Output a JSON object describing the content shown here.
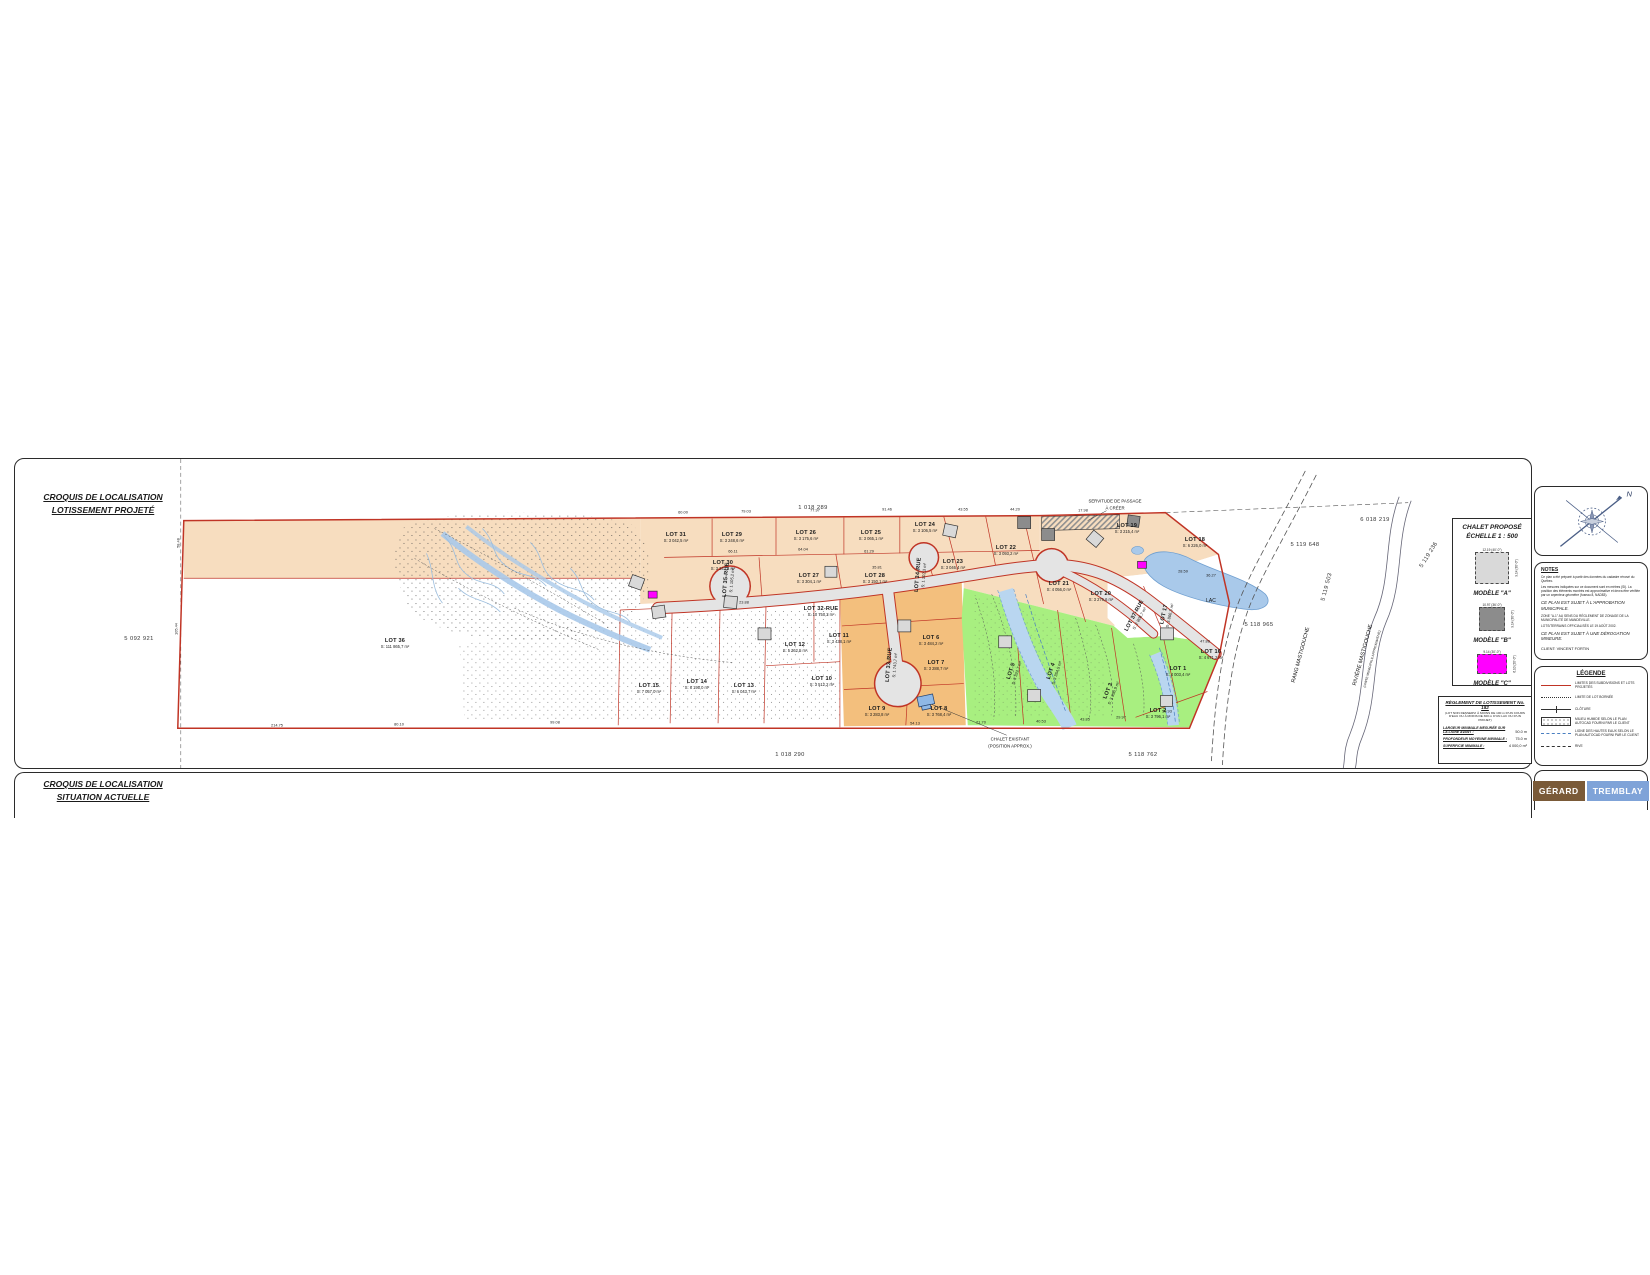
{
  "sheet1": {
    "title_line1": "CROQUIS DE LOCALISATION",
    "title_line2": "LOTISSEMENT PROJETÉ"
  },
  "sheet2": {
    "title_line1": "CROQUIS DE LOCALISATION",
    "title_line2": "SITUATION ACTUELLE"
  },
  "compass": {
    "north_label": "N"
  },
  "chalet_block": {
    "title_line1": "CHALET PROPOSÉ",
    "title_line2": "ÉCHELLE 1 : 500",
    "models": [
      {
        "label": "MODÈLE \"A\"",
        "color": "#d9d9d9",
        "top_dim": "12.19 (40'-0\")",
        "side_dim": "9.14 (30'-0\")",
        "w": 34,
        "h": 32
      },
      {
        "label": "MODÈLE \"B\"",
        "color": "#8c8c8c",
        "top_dim": "10.97 (36'-0\")",
        "side_dim": "9.14 (30'-0\")",
        "w": 26,
        "h": 24
      },
      {
        "label": "MODÈLE \"C\"",
        "color": "#ff00ff",
        "top_dim": "9.14 (30'-0\")",
        "side_dim": "6.10 (20'-0\")",
        "w": 30,
        "h": 20
      }
    ]
  },
  "reglement": {
    "title": "RÈGLEMENT DE LOTISSEMENT No. 182",
    "subtitle": "(LOT NON DESSERVI À MOINS DE 100 m D'UN COURS D'EAU OU À MOINS DE 300 m D'UN LAC OU D'UN PROJET)",
    "rows": [
      {
        "label": "LARGEUR MINIMALE MESURÉE SUR LA LIGNE AVANT :",
        "value": "50.0 m"
      },
      {
        "label": "PROFONDEUR MOYENNE MINIMALE :",
        "value": "75.0 m"
      },
      {
        "label": "SUPERFICIE MINIMALE :",
        "value": "4 000,0 m²"
      }
    ]
  },
  "notes": {
    "title": "NOTES",
    "lines": [
      "Ce plan a été préparé à partir des données du cadastre rénové du Québec.",
      "Les mesures indiquées sur ce document sont en mètres (SI). La position des éléments montrés est approximative et devra être vérifiée par un arpenteur-géomètre (fuseau 8, NAD83)."
    ],
    "emph1": "CE PLAN EST SUJET À L'APPROBATION MUNICIPALE.",
    "zone_line": "ZONE \"A-1\" AU SENS DU RÈGLEMENT DE ZONAGE DE LA MUNICIPALITÉ DE MANDEVILLE.",
    "off_line": "LOTS/TERRAINS OFFICIALISÉS LE 19 AOÛT 2002.",
    "emph2": "CE PLAN EST SUJET À UNE DÉROGATION MINEURE.",
    "client": "CLIENT: VINCENT FORTIN"
  },
  "legende": {
    "title": "LÉGENDE",
    "items": [
      {
        "symbol": "red-line",
        "label": "LIMITES DES SUBDIVISIONS ET LOTS PROJETÉS"
      },
      {
        "symbol": "dotted-line",
        "label": "LIMITE DE LOT BORNÉE"
      },
      {
        "symbol": "tick-line",
        "label": "CLÔTURE"
      },
      {
        "symbol": "wetland-box",
        "label": "MILIEU HUMIDE SELON LE PLAN AUTOCAD FOURNI PAR LE CLIENT"
      },
      {
        "symbol": "blue-dash",
        "label": "LIGNE DES HAUTES EAUX SELON LE PLAN AUTOCAD FOURNI PAR LE CLIENT"
      },
      {
        "symbol": "long-dash",
        "label": "RIVE"
      }
    ]
  },
  "logo": {
    "part1": "GÉRARD",
    "part2": "TREMBLAY"
  },
  "plan": {
    "lots": [
      {
        "name": "LOT 36",
        "area": "S: 111 865,7 m²",
        "x": 380,
        "y": 185
      },
      {
        "name": "LOT 15",
        "area": "S: 7 057,0 m²",
        "x": 634,
        "y": 230
      },
      {
        "name": "LOT 14",
        "area": "S: 6 195,0 m²",
        "x": 682,
        "y": 226
      },
      {
        "name": "LOT 13",
        "area": "S: 6 043,7 m²",
        "x": 729,
        "y": 230
      },
      {
        "name": "LOT 12",
        "area": "S: 5 362,5 m²",
        "x": 780,
        "y": 189
      },
      {
        "name": "LOT 11",
        "area": "S: 3 438,1 m²",
        "x": 824,
        "y": 180
      },
      {
        "name": "LOT 10",
        "area": "S: 3 512,2 m²",
        "x": 807,
        "y": 223
      },
      {
        "name": "LOT 9",
        "area": "S: 3 283,8 m²",
        "x": 862,
        "y": 253
      },
      {
        "name": "LOT 8",
        "area": "S: 3 768,4 m²",
        "x": 924,
        "y": 253
      },
      {
        "name": "LOT 7",
        "area": "S: 3 288,7 m²",
        "x": 921,
        "y": 207
      },
      {
        "name": "LOT 6",
        "area": "S: 3 484,2 m²",
        "x": 916,
        "y": 182
      },
      {
        "name": "LOT 5",
        "area": "S: 3 322,7 m²",
        "x": 999,
        "y": 213,
        "rot": -72
      },
      {
        "name": "LOT 4",
        "area": "S: 3 354,5 m²",
        "x": 1039,
        "y": 213,
        "rot": -72
      },
      {
        "name": "LOT 3",
        "area": "S: 3 896,9 m²",
        "x": 1096,
        "y": 233,
        "rot": -68
      },
      {
        "name": "LOT 2",
        "area": "S: 3 796,1 m²",
        "x": 1143,
        "y": 255
      },
      {
        "name": "LOT 1",
        "area": "S: 4 003,4 m²",
        "x": 1163,
        "y": 213
      },
      {
        "name": "LOT 16",
        "area": "S: 4 671,2 m²",
        "x": 1196,
        "y": 196
      },
      {
        "name": "LOT 17",
        "area": "S: 3 866,3 m²",
        "x": 1152,
        "y": 156,
        "rot": -78
      },
      {
        "name": "LOT 18",
        "area": "S: 6 226,0 m²",
        "x": 1180,
        "y": 84
      },
      {
        "name": "LOT 19",
        "area": "S: 3 215,4 m²",
        "x": 1112,
        "y": 70
      },
      {
        "name": "LOT 20",
        "area": "S: 3 276,6 m²",
        "x": 1086,
        "y": 138
      },
      {
        "name": "LOT 21",
        "area": "S: 4 056,0 m²",
        "x": 1044,
        "y": 128
      },
      {
        "name": "LOT 22",
        "area": "S: 3 093,2 m²",
        "x": 991,
        "y": 92
      },
      {
        "name": "LOT 23",
        "area": "S: 3 046,4 m²",
        "x": 938,
        "y": 106
      },
      {
        "name": "LOT 24",
        "area": "S: 3 106,5 m²",
        "x": 910,
        "y": 69
      },
      {
        "name": "LOT 25",
        "area": "S: 3 065,1 m²",
        "x": 856,
        "y": 77
      },
      {
        "name": "LOT 26",
        "area": "S: 3 175,6 m²",
        "x": 791,
        "y": 77
      },
      {
        "name": "LOT 27",
        "area": "S: 3 304,1 m²",
        "x": 794,
        "y": 120
      },
      {
        "name": "LOT 28",
        "area": "S: 3 150,1 m²",
        "x": 860,
        "y": 120
      },
      {
        "name": "LOT 29",
        "area": "S: 3 248,6 m²",
        "x": 717,
        "y": 79
      },
      {
        "name": "LOT 30",
        "area": "S: 3 243,4 m²",
        "x": 708,
        "y": 107
      },
      {
        "name": "LOT 31",
        "area": "S: 3 042,5 m²",
        "x": 661,
        "y": 79
      },
      {
        "name": "LOT 32-RUE",
        "area": "S: 10 750,3 m²",
        "x": 806,
        "y": 153
      },
      {
        "name": "LOT 33-RUE",
        "area": "S: 1 743,7 m²",
        "x": 877,
        "y": 206,
        "rot": -85
      },
      {
        "name": "LOT 34-RUE",
        "area": "S: 1 102,3 m²",
        "x": 906,
        "y": 116,
        "rot": -85
      },
      {
        "name": "LOT 35-RUE",
        "area": "S: 1 105,2 m²",
        "x": 714,
        "y": 121,
        "rot": -85
      },
      {
        "name": "LOT 37-RUE",
        "area": "S: 2 808,7 m²",
        "x": 1122,
        "y": 158,
        "rot": -62
      }
    ],
    "cadastre": [
      {
        "t": "1 018 289",
        "x": 798,
        "y": 49
      },
      {
        "t": "1 018 290",
        "x": 775,
        "y": 296
      },
      {
        "t": "5 092 921",
        "x": 124,
        "y": 180
      },
      {
        "t": "5 119 648",
        "x": 1290,
        "y": 86
      },
      {
        "t": "5 119 503",
        "x": 1312,
        "y": 128,
        "rot": -75
      },
      {
        "t": "5 119 236",
        "x": 1414,
        "y": 96,
        "rot": -58
      },
      {
        "t": "5 118 965",
        "x": 1244,
        "y": 166
      },
      {
        "t": "5 118 762",
        "x": 1128,
        "y": 296
      },
      {
        "t": "6 018 219",
        "x": 1360,
        "y": 61
      }
    ],
    "labels": [
      {
        "t": "SERVITUDE DE PASSAGE",
        "x": 1100,
        "y": 42
      },
      {
        "t": "À CRÉER",
        "x": 1100,
        "y": 49
      },
      {
        "t": "LAC",
        "x": 1196,
        "y": 142,
        "size": 5
      },
      {
        "t": "CHALET EXISTANT",
        "x": 995,
        "y": 280
      },
      {
        "t": "(POSITION APPROX.)",
        "x": 995,
        "y": 287
      },
      {
        "t": "RANG MASTIGOUCHE",
        "x": 1286,
        "y": 196,
        "rot": -75,
        "size": 5.4
      },
      {
        "t": "RIVIÈRE MASTIGOUCHE",
        "x": 1348,
        "y": 196,
        "rot": -75,
        "size": 5.4
      },
      {
        "t": "(LIMITE MUNICIPALE APPROXIMATIVE)",
        "x": 1357,
        "y": 200,
        "rot": -75,
        "size": 3.2
      }
    ],
    "dims": [
      {
        "t": "60.00",
        "x": 668,
        "y": 53
      },
      {
        "t": "79.03",
        "x": 731,
        "y": 52
      },
      {
        "t": "77.97",
        "x": 800,
        "y": 51
      },
      {
        "t": "91.46",
        "x": 872,
        "y": 50
      },
      {
        "t": "43.55",
        "x": 948,
        "y": 50
      },
      {
        "t": "44.20",
        "x": 1000,
        "y": 50
      },
      {
        "t": "17.98",
        "x": 1068,
        "y": 51
      },
      {
        "t": "66.11",
        "x": 718,
        "y": 92
      },
      {
        "t": "64.04",
        "x": 788,
        "y": 90
      },
      {
        "t": "61.29",
        "x": 854,
        "y": 92
      },
      {
        "t": "58.48",
        "x": 163,
        "y": 84,
        "rot": -90
      },
      {
        "t": "105.44",
        "x": 161,
        "y": 170,
        "rot": -90
      },
      {
        "t": "214.75",
        "x": 262,
        "y": 266
      },
      {
        "t": "80.10",
        "x": 384,
        "y": 265
      },
      {
        "t": "99.08",
        "x": 540,
        "y": 263
      },
      {
        "t": "54.13",
        "x": 900,
        "y": 264
      },
      {
        "t": "21.70",
        "x": 966,
        "y": 263
      },
      {
        "t": "40.53",
        "x": 1026,
        "y": 262
      },
      {
        "t": "43.85",
        "x": 1070,
        "y": 260
      },
      {
        "t": "29.97",
        "x": 1106,
        "y": 258
      },
      {
        "t": "50.93",
        "x": 1152,
        "y": 252
      },
      {
        "t": "47.88",
        "x": 1190,
        "y": 182
      },
      {
        "t": "28.59",
        "x": 1168,
        "y": 112
      },
      {
        "t": "36.27",
        "x": 1196,
        "y": 116
      },
      {
        "t": "23.88",
        "x": 729,
        "y": 143
      },
      {
        "t": "35.81",
        "x": 862,
        "y": 108
      }
    ]
  }
}
